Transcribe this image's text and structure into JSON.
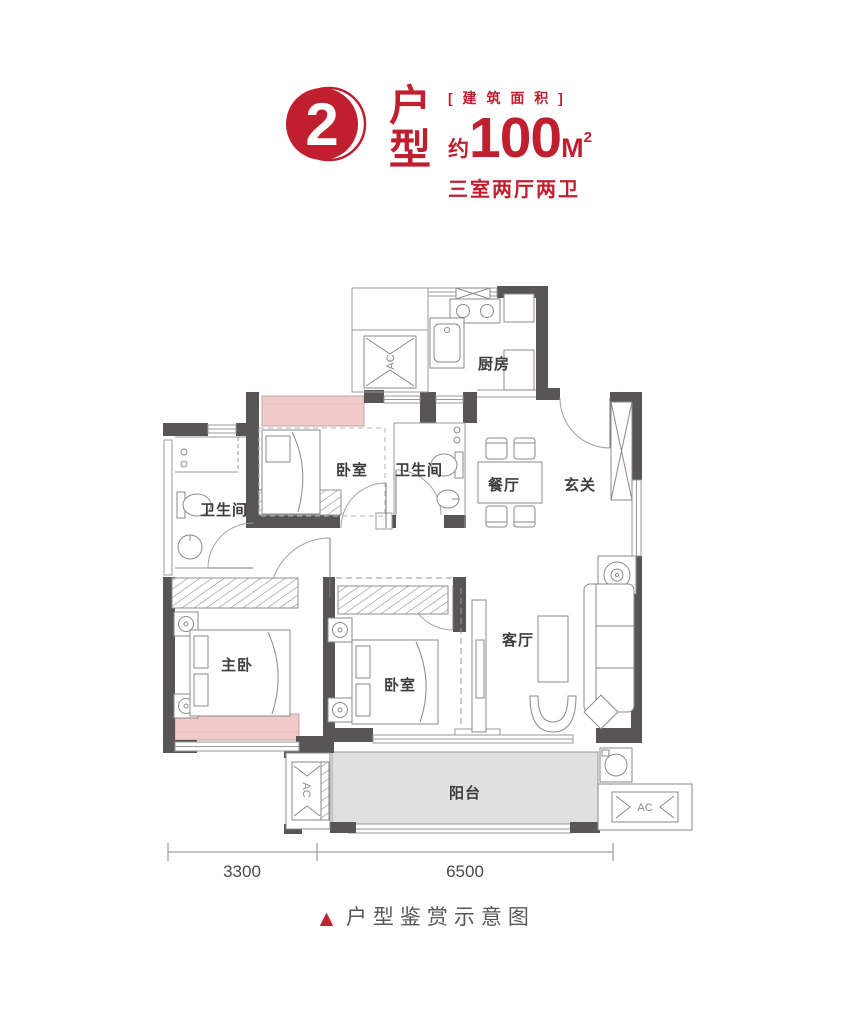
{
  "header": {
    "badge_number": "2",
    "badge_title_char1": "户",
    "badge_title_char2": "型",
    "area_label": "[ 建 筑 面 积 ]",
    "area_approx": "约",
    "area_value": "100",
    "area_unit": "M",
    "area_unit_exp": "2",
    "layout_summary": "三室两厅两卫"
  },
  "plan": {
    "rooms": {
      "kitchen": "厨房",
      "bedroom_top": "卧室",
      "bathroom_en_suite": "卫生间",
      "bathroom_main": "卫生间",
      "dining": "餐厅",
      "foyer": "玄关",
      "master_bedroom": "主卧",
      "bedroom_south": "卧室",
      "living": "客厅",
      "balcony": "阳台"
    },
    "equipment": {
      "ac_top": "AC",
      "ac_balcony_left": "AC",
      "ac_balcony_right": "AC"
    },
    "dimensions": {
      "width_left_mm": "3300",
      "width_right_mm": "6500"
    }
  },
  "footer": {
    "marker": "▲",
    "caption": "户型鉴赏示意图"
  },
  "colors": {
    "accent_red": "#bf1f2e",
    "wall_dark": "#585557",
    "bay_pink": "#f2caca",
    "balcony_gray": "#e0e0e0"
  }
}
